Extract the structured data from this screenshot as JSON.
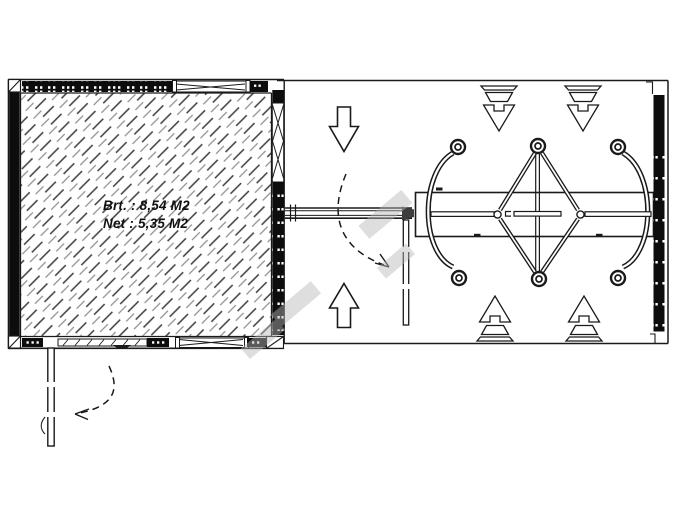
{
  "plan": {
    "storage_room": {
      "gross_area_label": "Brt. : 8,54 M2",
      "net_area_label": "Net : 5,35 M2"
    }
  },
  "colors": {
    "ink": "#1a1a1a",
    "wall_fill": "#0d0d0d",
    "hatch_dark": "#3c3c3c",
    "hatch_light": "#8f8f8f",
    "watermark": "#b8b8b8",
    "background": "#ffffff"
  }
}
